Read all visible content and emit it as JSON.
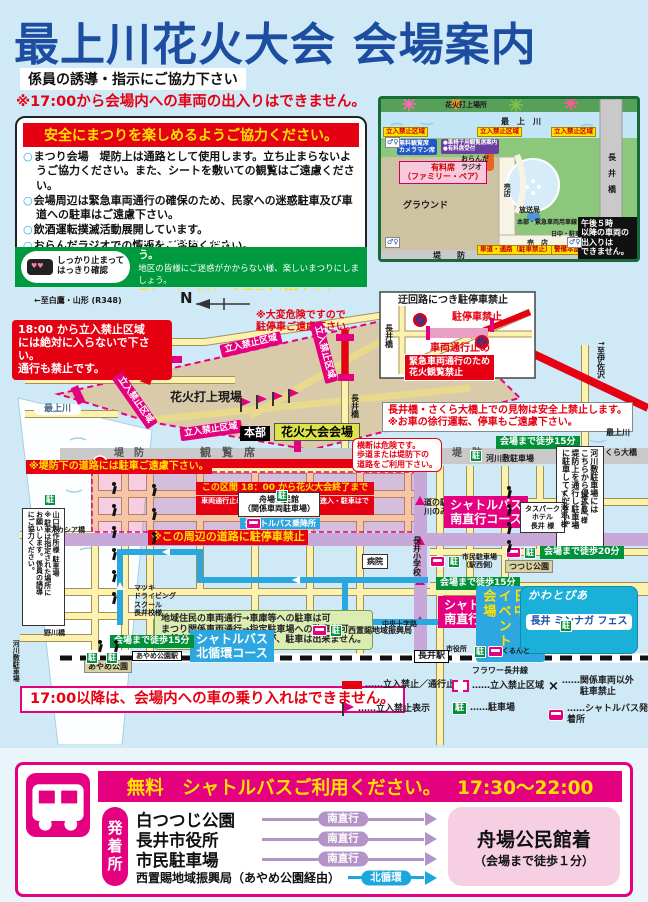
{
  "colors": {
    "title_blue": "#1c4da0",
    "red": "#e50012",
    "accent_pink": "#e4007f",
    "green": "#00913a",
    "yellow": "#ffe100",
    "shuttle_purple": "#b493c8",
    "shuttle_cyan": "#1ba6dd"
  },
  "header": {
    "title": "最上川花火大会 会場案内",
    "subtitle": "係員の誘導・指示にご協力下さい",
    "warning": "※17:00から会場内への車両の出入りはできません。"
  },
  "safety_box": {
    "header": "安全にまつりを楽しめるようご協力ください。",
    "items": [
      "まつり会場　堤防上は通路として使用します。立ち止まらないようご協力ください。また、シートを敷いての観覧はご遠慮ください。",
      "会場周辺は緊急車両通行の確保のため、民家への迷惑駐車及び車道への駐車はご遠慮下さい。",
      "飲酒運転撲滅活動展開しています。",
      "おらんだラジオでの情報をご活用ください。"
    ]
  },
  "manner_box": {
    "mascot": "しっかり止まって\nはっきり確認",
    "lines": [
      "ゴミは必ず持ち帰り、町をきれいにしましょう。",
      "地区の皆様にご迷惑がかからない様、楽しいまつりにしましょう。",
      "楽しいまつりは、交通安全が基本です。"
    ]
  },
  "mini_map": {
    "labels": [
      {
        "t": "花火打上場所",
        "c": "mm s6",
        "x": 64,
        "y": 2
      },
      {
        "t": "最　上　川",
        "c": "mm s7 navy",
        "x": 120,
        "y": 18
      },
      {
        "t": "立入禁止区域",
        "c": "mm-yellow",
        "x": 2,
        "y": 28
      },
      {
        "t": "立入禁止区域",
        "c": "mm-yellow",
        "x": 96,
        "y": 28
      },
      {
        "t": "立入禁止区域",
        "c": "mm-yellow",
        "x": 170,
        "y": 28
      },
      {
        "t": "無料観覧席\nカメラマン席",
        "c": "mm-blue",
        "x": 16,
        "y": 40
      },
      {
        "t": "●車椅子用観覧席案内\n●有料席受付",
        "c": "mm-purple",
        "x": 60,
        "y": 40
      },
      {
        "t": "有料席\n（ファミリー・ペア）",
        "c": "mm-pink",
        "x": 18,
        "y": 62
      },
      {
        "t": "グラウンド",
        "c": "mm s8 white",
        "x": 22,
        "y": 102
      },
      {
        "t": "おらんだ\nラジオ",
        "c": "mm s6",
        "x": 80,
        "y": 56
      },
      {
        "t": "売店",
        "c": "mm s6 vert",
        "x": 122,
        "y": 84
      },
      {
        "t": "売　店",
        "c": "mm s6",
        "x": 146,
        "y": 140
      },
      {
        "t": "放送局",
        "c": "mm s6",
        "x": 138,
        "y": 107
      },
      {
        "t": "本部・緊急車両用車線",
        "c": "mm s5 red",
        "x": 136,
        "y": 120
      },
      {
        "t": "日中・駐車場",
        "c": "mm s5",
        "x": 170,
        "y": 132
      },
      {
        "t": "車道・通路（駐車禁止）",
        "c": "mm-yellow s5",
        "x": 96,
        "y": 146
      },
      {
        "t": "警備本部",
        "c": "mm-yellow s5",
        "x": 170,
        "y": 146
      },
      {
        "t": "堤　　防",
        "c": "mm s7 gray2",
        "x": 52,
        "y": 152
      },
      {
        "t": "長　井　橋",
        "c": "mm s7 vert",
        "x": 226,
        "y": 54
      },
      {
        "t": "午後５時\n以降の車両の\n出入りは\nできません。",
        "c": "mm-black",
        "x": 197,
        "y": 118
      }
    ],
    "wc_icons": [
      [
        4,
        38
      ],
      [
        4,
        138
      ],
      [
        186,
        138
      ]
    ]
  },
  "main_map": {
    "parking_glyph": "駐",
    "annotations": [
      {
        "t": "←至白鷹・山形 (R348)",
        "c": "plain s7",
        "x": 34,
        "y": 6
      },
      {
        "t": "N",
        "c": "plain s14",
        "x": 180,
        "y": 0
      },
      {
        "t": "※大変危険ですので\n駐停車ご遠慮下さい。",
        "c": "red-text s9",
        "x": 256,
        "y": 20
      },
      {
        "t": "18:00 から立入禁止区域\nには絶対に入らないで下さい。\n通行も禁止です。",
        "c": "bubble-red",
        "x": 12,
        "y": 30,
        "w": 160
      },
      {
        "t": "立入禁止区域",
        "c": "pink-tag rotm13",
        "x": 220,
        "y": 48
      },
      {
        "t": "立入禁止区域",
        "c": "pink-tag rot55",
        "x": 104,
        "y": 104
      },
      {
        "t": "立入禁止区域",
        "c": "pink-tag rotm8",
        "x": 180,
        "y": 134
      },
      {
        "t": "立入禁止区域",
        "c": "pink-tag rot75",
        "x": 293,
        "y": 56
      },
      {
        "t": "花火打上現場",
        "c": "plain s11",
        "x": 170,
        "y": 100
      },
      {
        "t": "最上川",
        "c": "river-label",
        "x": 34,
        "y": 114
      },
      {
        "t": "本部",
        "c": "black-tag",
        "x": 240,
        "y": 136
      },
      {
        "t": "花火大会会場",
        "c": "venue-tag",
        "x": 274,
        "y": 133
      },
      {
        "t": "堤　防",
        "c": "plain s9 gray2",
        "x": 114,
        "y": 158
      },
      {
        "t": "観　覧　席",
        "c": "plain s10 gray2",
        "x": 200,
        "y": 157
      },
      {
        "t": "堤　防",
        "c": "plain s9 gray2",
        "x": 452,
        "y": 158
      },
      {
        "t": "※堤防下の道路には駐車ご遠慮下さい。",
        "c": "yellow-on-red s9",
        "x": 26,
        "y": 170
      },
      {
        "t": "この区間 18：00 から花火大会終了まで",
        "c": "redbox-line1 s8",
        "x": 196,
        "y": 192,
        "w": 178
      },
      {
        "t": "車両通行止めになりますので、車両の進入・駐車はできません。",
        "c": "redbox-line2 s6",
        "x": 196,
        "y": 206,
        "w": 178
      },
      {
        "t": "迂回路につき駐停車禁止",
        "c": "plain s9",
        "x": 398,
        "y": 5
      },
      {
        "t": "駐停車禁止",
        "c": "red-text s9",
        "x": 452,
        "y": 22
      },
      {
        "t": "車両通行止め",
        "c": "red-text s9",
        "x": 430,
        "y": 53
      },
      {
        "t": "緊急車両通行のため\n花火観覧禁止",
        "c": "red-box s8",
        "x": 404,
        "y": 64
      },
      {
        "t": "長井橋",
        "c": "plain vert s7",
        "x": 384,
        "y": 34
      },
      {
        "t": "長井橋",
        "c": "plain vert s7",
        "x": 350,
        "y": 104
      },
      {
        "t": "↑至伊佐沢",
        "c": "plain vert s7",
        "x": 596,
        "y": 50
      },
      {
        "t": "長井橋・さくら大橋上での見物は安全上禁止します。\n※お車の徐行運転、停車もご遠慮下さい。",
        "c": "white-box-red s9",
        "x": 382,
        "y": 112
      },
      {
        "t": "最上川",
        "c": "plain s7",
        "x": 606,
        "y": 138
      },
      {
        "t": "さくら大橋",
        "c": "plain s7",
        "x": 597,
        "y": 158
      },
      {
        "t": "会場まで徒歩15分",
        "c": "green-badge",
        "x": 496,
        "y": 146
      },
      {
        "t": "河川敷駐車場",
        "c": "plain s7",
        "x": 486,
        "y": 164
      },
      {
        "t": "横断は危険です。\n歩道または堤防下の\n道路をご利用下さい。",
        "c": "bubble-white-red s7",
        "x": 352,
        "y": 148
      },
      {
        "t": "河川敷駐車場には\nこちらから侵入し、\n堤防上を通行し駐車場\nに駐車してください。",
        "c": "white-box s7 vert vh112",
        "x": 556,
        "y": 156
      },
      {
        "t": "舟場公民館\n（関係車両駐車場）",
        "c": "white-box s7 ctr",
        "x": 238,
        "y": 202
      },
      {
        "t": "シャトルバス乗降所",
        "c": "blue-tag s7",
        "x": 240,
        "y": 228
      },
      {
        "t": "※この周辺の道路に駐停車禁止",
        "c": "yellow-on-red s10",
        "x": 148,
        "y": 240
      },
      {
        "t": "道の駅\n川のみなと長井",
        "c": "plain s7",
        "x": 424,
        "y": 208
      },
      {
        "t": "長井小学校",
        "c": "plain vert s7",
        "x": 412,
        "y": 246
      },
      {
        "t": "病院",
        "c": "white-box s7",
        "x": 362,
        "y": 264
      },
      {
        "t": "地域住民の車両通行→車庫等への駐車は可\nまつり関係車両通行→指定駐車場への駐車は可\n一般車両の通行→可能ですが、駐車は出来ません。",
        "c": "green-box s8",
        "x": 154,
        "y": 320
      },
      {
        "t": "シャトルバス\n南直行コース",
        "c": "pink-tag-big",
        "x": 444,
        "y": 206
      },
      {
        "t": "タスパーク\nホテル\n長井 様",
        "c": "white-box s6 ctr",
        "x": 520,
        "y": 212
      },
      {
        "t": "すし海道 様",
        "c": "plain vert s6",
        "x": 560,
        "y": 200
      },
      {
        "t": "福祉屋 様",
        "c": "plain vert s6",
        "x": 580,
        "y": 203
      },
      {
        "t": "つつじ公園",
        "c": "khaki-box s7",
        "x": 505,
        "y": 270
      },
      {
        "t": "会場まで徒歩20分",
        "c": "green-badge",
        "x": 540,
        "y": 256
      },
      {
        "t": "市民駐車場\n（駅西側）",
        "c": "plain s6",
        "x": 462,
        "y": 263
      },
      {
        "t": "会場まで徒歩15分",
        "c": "green-badge",
        "x": 436,
        "y": 287
      },
      {
        "t": "シャトルバス\n南直行コース",
        "c": "pink-tag-big",
        "x": 438,
        "y": 306
      },
      {
        "t": "水まつり日中\nイベント会場",
        "c": "blue-banner",
        "x": 476,
        "y": 296,
        "h": 76
      },
      {
        "t": "",
        "c": "logo-bg",
        "x": 520,
        "y": 296,
        "w": 118,
        "h": 68
      },
      {
        "t": "かわとぴあ",
        "c": "logo-kawa",
        "x": 528,
        "y": 300
      },
      {
        "t": "長井 ミンナガ フェス",
        "c": "logo-fes",
        "x": 526,
        "y": 324,
        "w": 106
      },
      {
        "t": "市役所",
        "c": "plain s6",
        "x": 446,
        "y": 355
      },
      {
        "t": "くるんと",
        "c": "plain s6",
        "x": 502,
        "y": 357
      },
      {
        "t": "長井駅",
        "c": "station-box s8",
        "x": 414,
        "y": 360
      },
      {
        "t": "フラワー長井線",
        "c": "plain s7",
        "x": 472,
        "y": 376
      },
      {
        "t": "中央十字路",
        "c": "plain s6",
        "x": 382,
        "y": 330
      },
      {
        "t": "西置賜地域振興局",
        "c": "plain s7",
        "x": 348,
        "y": 336
      },
      {
        "t": "シャトルバス\n北循環コース",
        "c": "blue-tag-big",
        "x": 190,
        "y": 340
      },
      {
        "t": "山口製作所様 駐車場\n※駐車は指定された場所に\nお願いします。係員の誘導\nにご協力ください。",
        "c": "white-box s6 vert vh118",
        "x": 22,
        "y": 218
      },
      {
        "t": "アカシア橋",
        "c": "plain s6",
        "x": 50,
        "y": 236
      },
      {
        "t": "マツキ\nドライビング\nスクール\n長井校様",
        "c": "plain s6",
        "x": 134,
        "y": 294
      },
      {
        "t": "野川橋",
        "c": "plain s6",
        "x": 44,
        "y": 339
      },
      {
        "t": "会場まで徒歩15分",
        "c": "green-badge",
        "x": 110,
        "y": 345
      },
      {
        "t": "あやめ公園",
        "c": "khaki-box s7",
        "x": 84,
        "y": 370
      },
      {
        "t": "あやめ公園駅",
        "c": "station-box s6",
        "x": 132,
        "y": 361
      },
      {
        "t": "河川敷駐車場",
        "c": "plain vert s6",
        "x": 12,
        "y": 350
      },
      {
        "t": "17:00以降は、会場内への車の乗り入れはできません。",
        "c": "alert-box",
        "x": 20,
        "y": 396
      }
    ],
    "parking_icons": [
      [
        44,
        204
      ],
      [
        470,
        160
      ],
      [
        276,
        200
      ],
      [
        448,
        266
      ],
      [
        474,
        356
      ],
      [
        330,
        335
      ],
      [
        86,
        362
      ],
      [
        106,
        362
      ],
      [
        524,
        257
      ],
      [
        560,
        330
      ]
    ],
    "bus_stop_icons": [
      [
        246,
        228
      ],
      [
        430,
        266
      ],
      [
        312,
        335
      ],
      [
        488,
        356
      ],
      [
        506,
        257
      ]
    ],
    "walkers": [
      [
        110,
        192
      ],
      [
        110,
        214
      ],
      [
        110,
        236
      ],
      [
        110,
        258
      ],
      [
        110,
        280
      ],
      [
        110,
        302
      ],
      [
        96,
        350
      ],
      [
        112,
        350
      ],
      [
        150,
        194
      ],
      [
        150,
        218
      ],
      [
        150,
        242
      ],
      [
        505,
        196
      ],
      [
        505,
        214
      ],
      [
        505,
        232
      ],
      [
        505,
        250
      ]
    ],
    "flags": [
      [
        240,
        108
      ],
      [
        256,
        105
      ],
      [
        272,
        102
      ],
      [
        288,
        99
      ]
    ]
  },
  "legend": {
    "items": [
      {
        "icon": "redbar",
        "label": "……立入禁止／通行止",
        "x": 342,
        "y": 390
      },
      {
        "icon": "flag",
        "label": "……立入禁止表示",
        "x": 342,
        "y": 412
      },
      {
        "icon": "dashbox",
        "label": "……立入禁止区域",
        "x": 452,
        "y": 390
      },
      {
        "icon": "parking",
        "label": "……駐車場",
        "x": 452,
        "y": 412
      },
      {
        "icon": "xmark",
        "label": "……関係車両以外\n　　駐車禁止",
        "x": 548,
        "y": 386
      },
      {
        "icon": "bus",
        "label": "……シャトルバス発着所",
        "x": 548,
        "y": 414
      }
    ]
  },
  "shuttle": {
    "header": "無料　シャトルバスご利用ください。",
    "hours": "17:30～22:00",
    "label": "発着所",
    "routes": [
      {
        "from": "白つつじ公園",
        "via": "南直行"
      },
      {
        "from": "長井市役所",
        "via": "南直行"
      },
      {
        "from": "市民駐車場",
        "via": "南直行"
      },
      {
        "from": "西置賜地域振興局（あやめ公園経由）",
        "via": "北循環",
        "cls": "north",
        "small": true
      }
    ],
    "dest": "舟場公民館着",
    "dest_note": "（会場まで徒歩１分）"
  }
}
